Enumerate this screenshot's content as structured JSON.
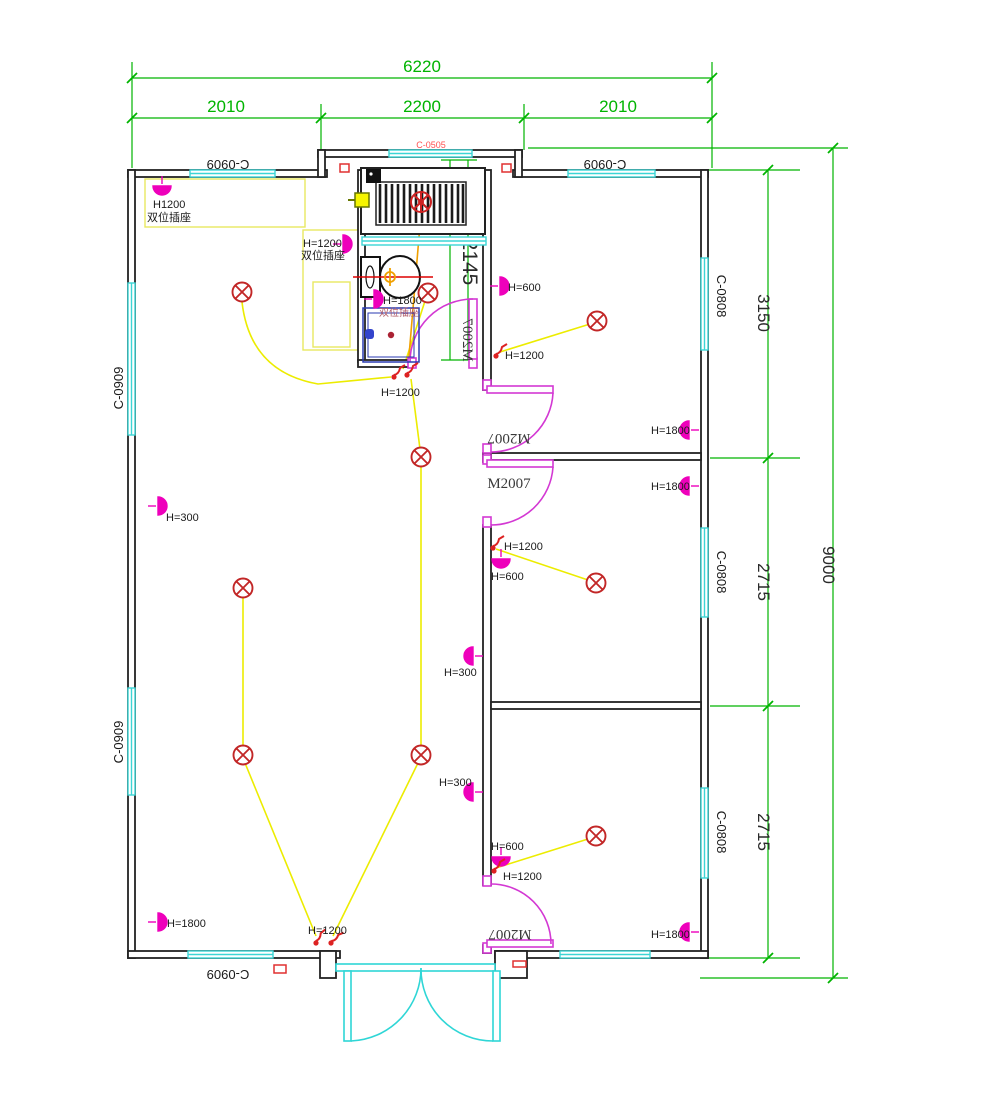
{
  "drawing": {
    "type": "electrical-floor-plan",
    "colors": {
      "wall": "#222222",
      "window_cyan": "#3cd5d5",
      "door_magenta": "#d338d3",
      "entry_door_cyan": "#2fd6d6",
      "dimension_green": "#00b400",
      "wire_yellow": "#ecec00",
      "wire_orange": "#f0a000",
      "lamp_red": "#c22727",
      "socket_magenta": "#ee00bb",
      "switch_red": "#dd2222",
      "window_code_red": "#ff5050",
      "counter_yellow": "#e8e860",
      "toilet_axis_red": "#dd0000",
      "sink_blue": "#2a3ab0"
    }
  },
  "dimensions": {
    "total_width": "6220",
    "seg_left": "2010",
    "seg_center": "2200",
    "seg_right": "2010",
    "room_top": "3150",
    "room_mid": "2715",
    "room_bottom": "2715",
    "total_height": "9000",
    "bathroom_depth": "2145"
  },
  "windows": {
    "code_0909": "C-0909",
    "code_0808": "C-0808",
    "code_0505": "C-0505"
  },
  "doors": {
    "code": "M2007"
  },
  "electrical": {
    "h1200_plain": "H1200",
    "dual_socket": "双位插座",
    "h1200": "H=1200",
    "h1800": "H=1800",
    "h600": "H=600",
    "h300": "H=300"
  }
}
